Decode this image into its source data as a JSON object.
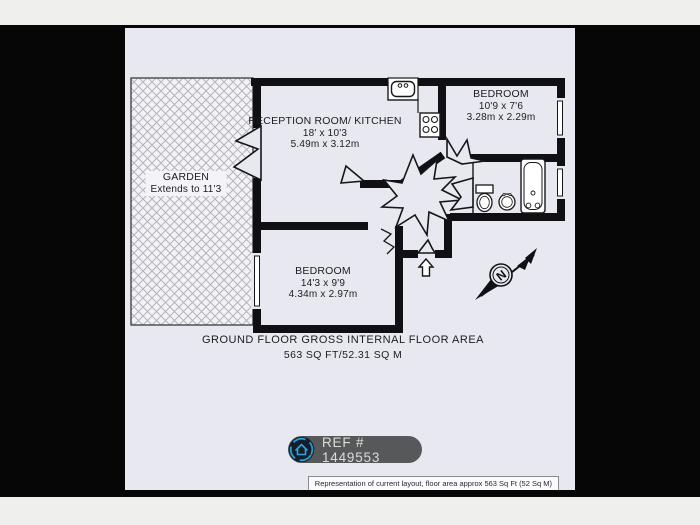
{
  "colors": {
    "page_bg": "#efefee",
    "band_bg": "#060606",
    "sheet_bg": "#e8e8f1",
    "wall": "#101014",
    "badge_bg": "#57585a",
    "badge_accent": "#2e9ad6"
  },
  "rooms": {
    "garden": {
      "name": "GARDEN",
      "note": "Extends to 11'3"
    },
    "reception": {
      "name": "RECEPTION ROOM/ KITCHEN",
      "imperial": "18' x 10'3",
      "metric": "5.49m x 3.12m"
    },
    "bedroom_top": {
      "name": "BEDROOM",
      "imperial": "10'9 x 7'6",
      "metric": "3.28m x 2.29m"
    },
    "bedroom_bottom": {
      "name": "BEDROOM",
      "imperial": "14'3 x 9'9",
      "metric": "4.34m x 2.97m"
    }
  },
  "footer": {
    "title": "GROUND FLOOR GROSS INTERNAL FLOOR AREA",
    "area": "563 SQ FT/52.31 SQ M"
  },
  "ref_badge": {
    "label": "REF # 1449553",
    "icon": "home-icon"
  },
  "compass": {
    "north": "N"
  },
  "disclaimer": "Representation of current layout, floor area approx 563 Sq Ft (52 Sq M)"
}
